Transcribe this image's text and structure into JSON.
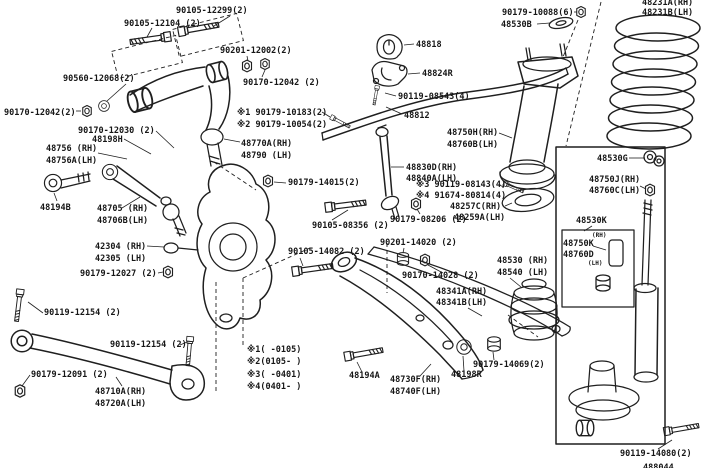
{
  "diagram": {
    "kind": "exploded-parts-diagram",
    "colors": {
      "background": "#ffffff",
      "line": "#1f1f1f"
    }
  },
  "part_labels": [
    {
      "text": "90105-12299(2)"
    },
    {
      "text": "90105-12104 (2)"
    },
    {
      "text": "90201-12002(2)"
    },
    {
      "text": "90170-12042 (2)"
    },
    {
      "text": "90560-12068(2)"
    },
    {
      "text": "90170-12042(2)"
    },
    {
      "text": "90170-12030 (2)"
    },
    {
      "text": "48198H"
    },
    {
      "text": "48756 (RH)"
    },
    {
      "text": "48756A(LH)"
    },
    {
      "text": "※1 90179-10183(2)"
    },
    {
      "text": "※2 90179-10054(2)"
    },
    {
      "text": "48770A(RH)"
    },
    {
      "text": "48790 (LH)"
    },
    {
      "text": "90179-14015(2)"
    },
    {
      "text": "48194B"
    },
    {
      "text": "48705 (RH)"
    },
    {
      "text": "48706B(LH)"
    },
    {
      "text": "42304 (RH)"
    },
    {
      "text": "42305 (LH)"
    },
    {
      "text": "90179-12027 (2)"
    },
    {
      "text": "90105-08356 (2)"
    },
    {
      "text": "90179-08206 (2)"
    },
    {
      "text": "48830D(RH)"
    },
    {
      "text": "48840A(LH)"
    },
    {
      "text": "※3 90119-08143(4)"
    },
    {
      "text": "※4 91674-80814(4)"
    },
    {
      "text": "48257C(RH)"
    },
    {
      "text": "48259A(LH)"
    },
    {
      "text": "48818"
    },
    {
      "text": "48824R"
    },
    {
      "text": "90119-08543(4)"
    },
    {
      "text": "48812"
    },
    {
      "text": "90179-10088(6)"
    },
    {
      "text": "48530B"
    },
    {
      "text": "48231A(RH)"
    },
    {
      "text": "48231B(LH)"
    },
    {
      "text": "48750H(RH)"
    },
    {
      "text": "48760B(LH)"
    },
    {
      "text": "48530G"
    },
    {
      "text": "48750J(RH)"
    },
    {
      "text": "48760C(LH)"
    },
    {
      "text": "48530K"
    },
    {
      "text": "(RH)"
    },
    {
      "text": "48750K"
    },
    {
      "text": "48760D"
    },
    {
      "text": "(LH)"
    },
    {
      "text": "48530 (RH)"
    },
    {
      "text": "48540 (LH)"
    },
    {
      "text": "90201-14020 (2)"
    },
    {
      "text": "90105-14082 (2)"
    },
    {
      "text": "90170-14028 (2)"
    },
    {
      "text": "48341A(RH)"
    },
    {
      "text": "48341B(LH)"
    },
    {
      "text": "90119-12154 (2)"
    },
    {
      "text": "90119-12154 (2)"
    },
    {
      "text": "90179-12091 (2)"
    },
    {
      "text": "48710A(RH)"
    },
    {
      "text": "48720A(LH)"
    },
    {
      "text": "48194A"
    },
    {
      "text": "48730F(RH)"
    },
    {
      "text": "48740F(LH)"
    },
    {
      "text": "48198R"
    },
    {
      "text": "90179-14069(2)"
    },
    {
      "text": "90119-14080(2)"
    },
    {
      "text": "488044"
    }
  ],
  "legend": {
    "entries": [
      "※1(    -0105)",
      "※2(0105-    )",
      "※3(    -0401)",
      "※4(0401-    )"
    ]
  }
}
